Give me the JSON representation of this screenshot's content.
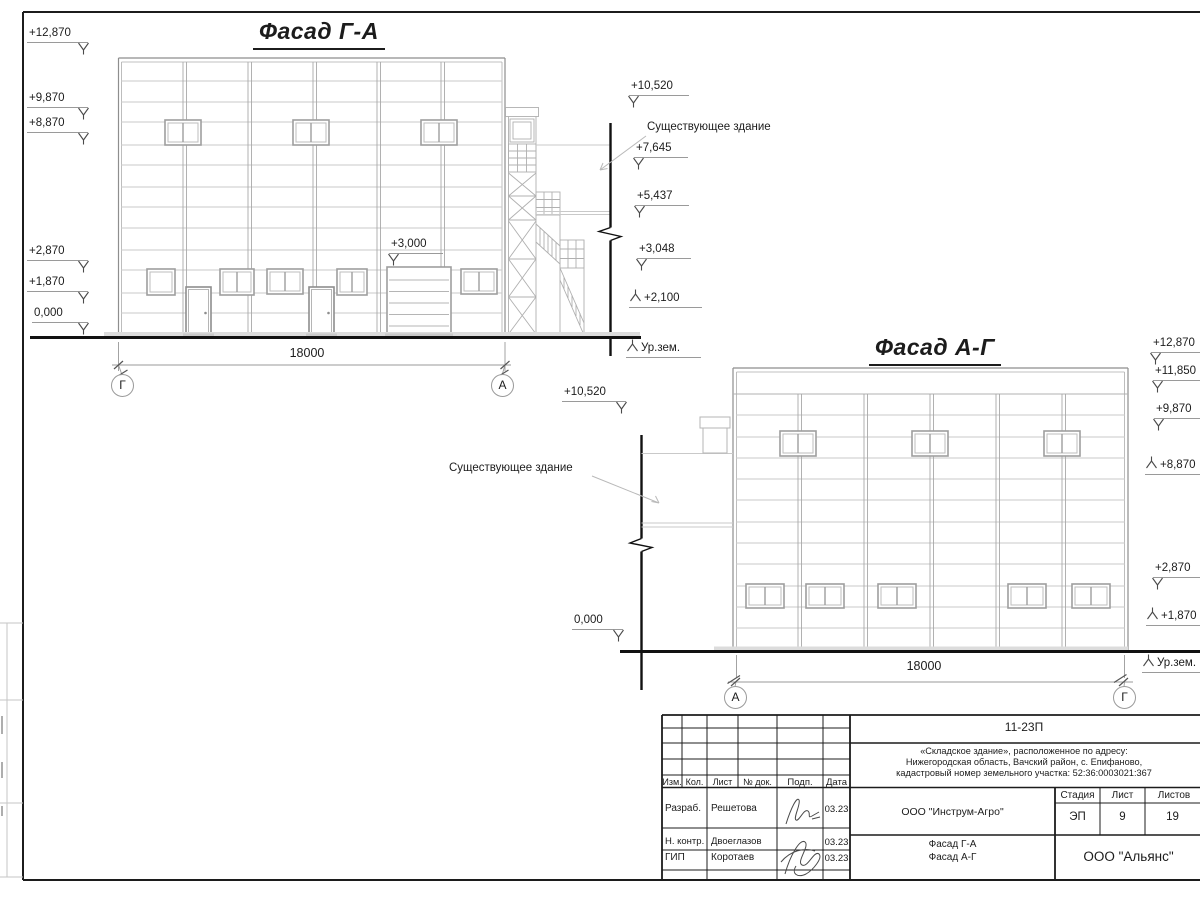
{
  "facade1": {
    "title": "Фасад Г-А",
    "dimension": "18000",
    "axis_left": "Г",
    "axis_right": "А",
    "left_marks": [
      "+12,870",
      "+9,870",
      "+8,870",
      "+2,870",
      "+1,870",
      "0,000"
    ],
    "gate_mark": "+3,000",
    "right_marks": [
      "+10,520",
      "+7,645",
      "+5,437",
      "+3,048",
      "+2,100"
    ],
    "ground_label": "Ур.зем.",
    "annotation": "Существующее здание"
  },
  "facade2": {
    "title": "Фасад А-Г",
    "dimension": "18000",
    "axis_left": "А",
    "axis_right": "Г",
    "left_marks": [
      "+10,520",
      "0,000"
    ],
    "right_marks": [
      "+12,870",
      "+11,850",
      "+9,870",
      "+8,870",
      "+2,870",
      "+1,870"
    ],
    "ground_label": "Ур.зем.",
    "annotation": "Существующее здание"
  },
  "title_block": {
    "code": "11-23П",
    "address_line1": "«Складское здание», расположенное по адресу:",
    "address_line2": "Нижегородская область, Вачский район, с. Епифаново,",
    "address_line3": "кадастровый номер земельного участка: 52:36:0003021:367",
    "col_izm": "Изм.",
    "col_kol": "Кол.",
    "col_list": "Лист",
    "col_doc": "№ док.",
    "col_podp": "Подп.",
    "col_data": "Дата",
    "rows": [
      {
        "role": "Разраб.",
        "name": "Решетова",
        "date": "03.23"
      },
      {
        "role": "Н. контр.",
        "name": "Двоеглазов",
        "date": "03.23"
      },
      {
        "role": "ГИП",
        "name": "Коротаев",
        "date": "03.23"
      }
    ],
    "org": "ООО \"Инструм-Агро\"",
    "stage_label": "Стадия",
    "sheet_label": "Лист",
    "sheets_label": "Листов",
    "stage": "ЭП",
    "sheet_no": "9",
    "sheets_total": "19",
    "drawing_name_line1": "Фасад Г-А",
    "drawing_name_line2": "Фасад А-Г",
    "company": "ООО \"Альянс\""
  }
}
